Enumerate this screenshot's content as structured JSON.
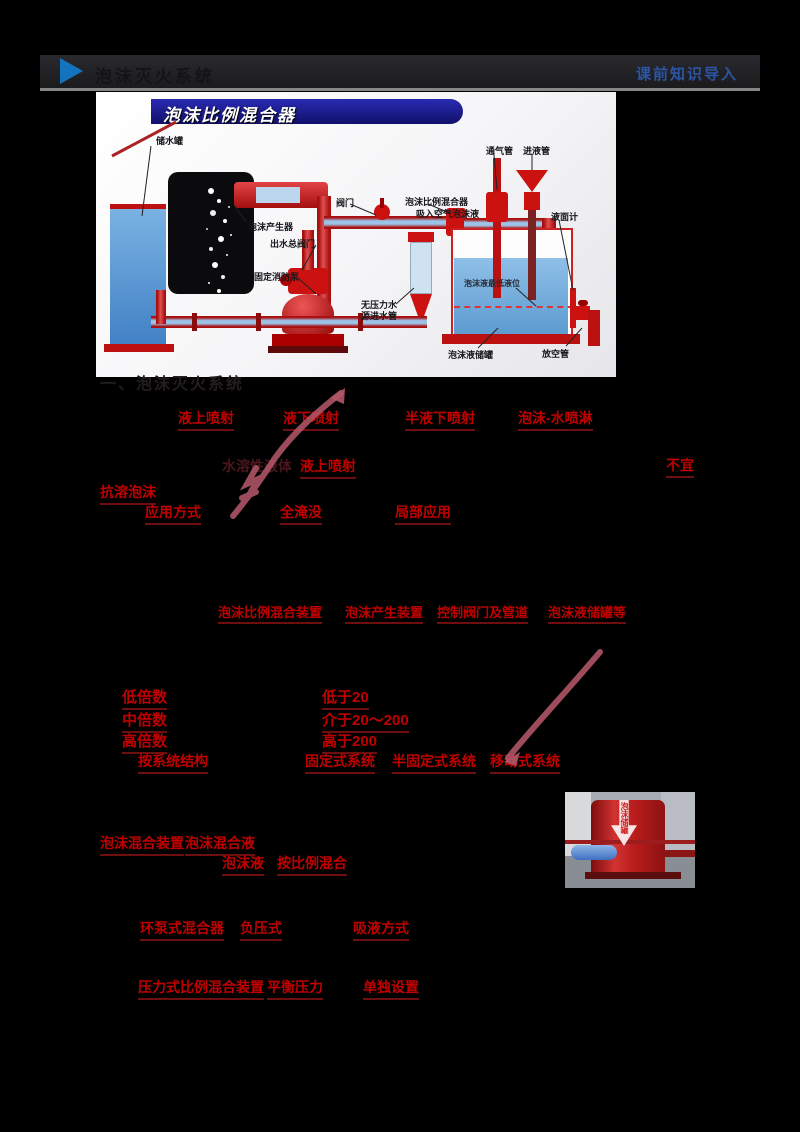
{
  "header": {
    "title": "泡沫灭火系统",
    "module_label": "课前知识导入",
    "accent_blue": "#1473be",
    "label_blue": "#2d55a6"
  },
  "diagram": {
    "banner_title": "泡沫比例混合器",
    "banner_blue": "#15158a",
    "labels": {
      "storage_tank": "储水罐",
      "foam_generator": "泡沫产生器",
      "outlet_valve": "出水总阀门",
      "fire_pump": "固定消防泵",
      "valve": "阀门",
      "proportioner": "泡沫比例混合器",
      "air_foam_intake": "吸入空气泡沫液",
      "vent_pipe": "通气管",
      "liquid_inlet_pipe": "进液管",
      "level_gauge": "液面计",
      "min_level": "泡沫液最低液位",
      "no_pressure_water": "无压力水",
      "water_inlet_pipe": "源进水管",
      "foam_tank": "泡沫液储罐",
      "drain_pipe": "放空管"
    }
  },
  "content": {
    "section_heading": "一、泡沫灭火系统",
    "spray_types": [
      "液上喷射",
      "液下喷射",
      "半液下喷射",
      "泡沫-水喷淋"
    ],
    "note_dark": "水溶性液体",
    "note_red": "液上喷射",
    "note_right": "不宜",
    "anti_foam": "抗溶泡沫",
    "application_row": [
      "应用方式",
      "全淹没",
      "局部应用"
    ],
    "components": [
      "泡沫比例混合装置",
      "泡沫产生装置",
      "控制阀门及管道",
      "泡沫液储罐等"
    ],
    "expansion_rows": [
      {
        "label": "低倍数",
        "value": "低于20"
      },
      {
        "label": "中倍数",
        "value": "介于20～200"
      },
      {
        "label": "高倍数",
        "value": "高于200"
      }
    ],
    "structure_row": {
      "label": "按系统结构",
      "items": [
        "固定式系统",
        "半固定式系统",
        "移动式系统"
      ]
    },
    "mixing": {
      "line1": [
        "泡沫混合装置",
        "泡沫混合液"
      ],
      "line2": [
        "泡沫液",
        "按比例混合"
      ]
    },
    "proportioner_row1": [
      "环泵式混合器",
      "负压式",
      "吸液方式"
    ],
    "proportioner_row2": [
      "压力式比例混合装置",
      "平衡压力",
      "单独设置"
    ]
  },
  "photo": {
    "annotation": "泡沫储罐"
  },
  "colors": {
    "red_text": "#c00000",
    "arrow_pink": "#b25668"
  }
}
